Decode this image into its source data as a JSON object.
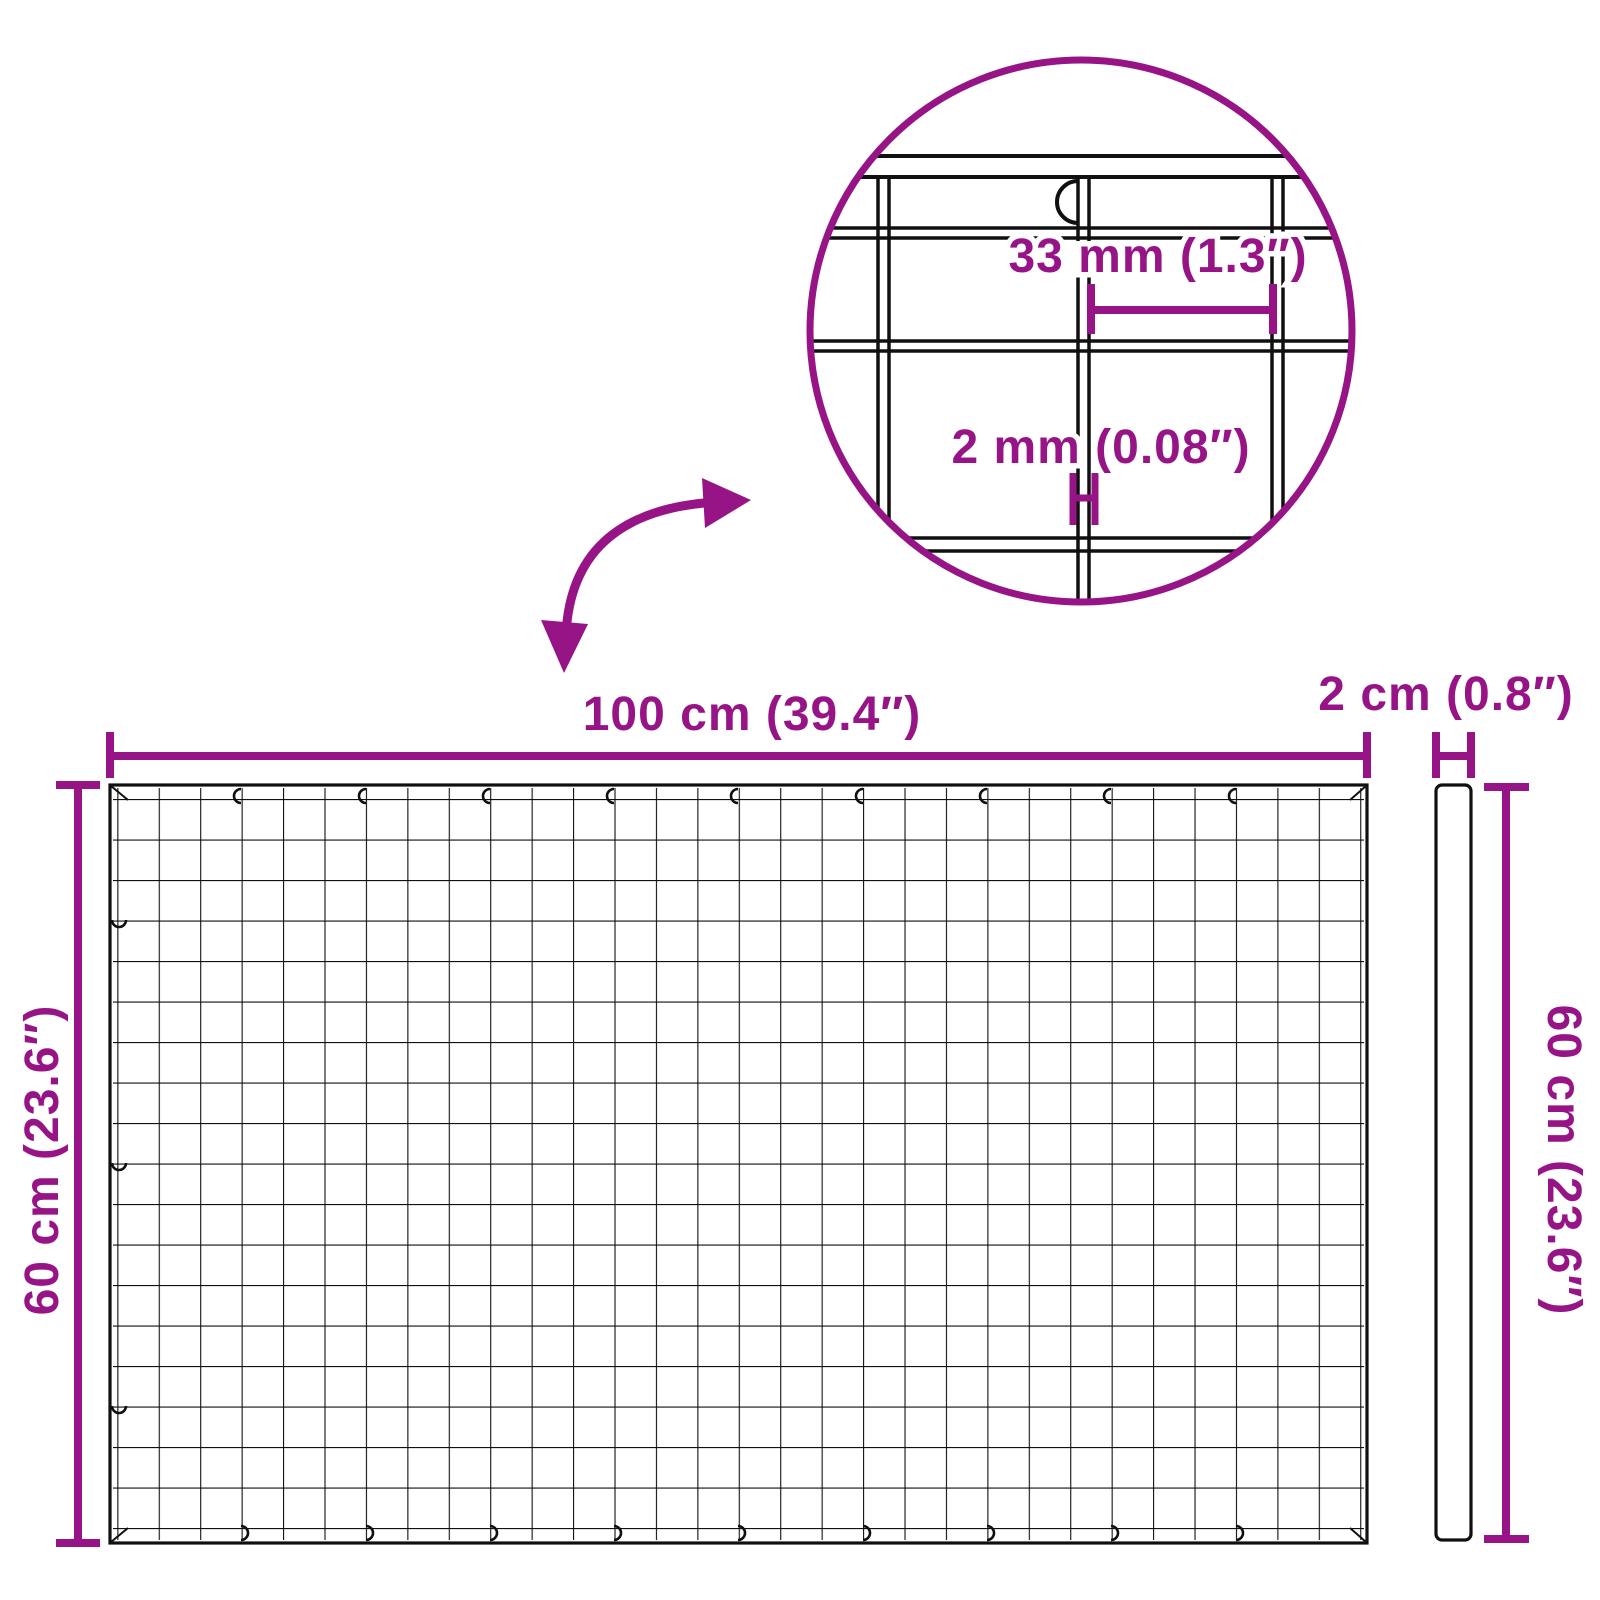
{
  "title": "Wire mesh panel dimension diagram",
  "colors": {
    "accent_purple": "#971487",
    "line_black": "#101010",
    "background": "#ffffff"
  },
  "detail_view": {
    "mesh_opening_label": "33 mm (1.3″)",
    "wire_thickness_label": "2 mm (0.08″)"
  },
  "front_view": {
    "width_label": "100 cm (39.4″)",
    "height_label": "60 cm (23.6″)"
  },
  "side_view": {
    "thickness_label": "2 cm (0.8″)",
    "height_label": "60 cm (23.6″)"
  }
}
